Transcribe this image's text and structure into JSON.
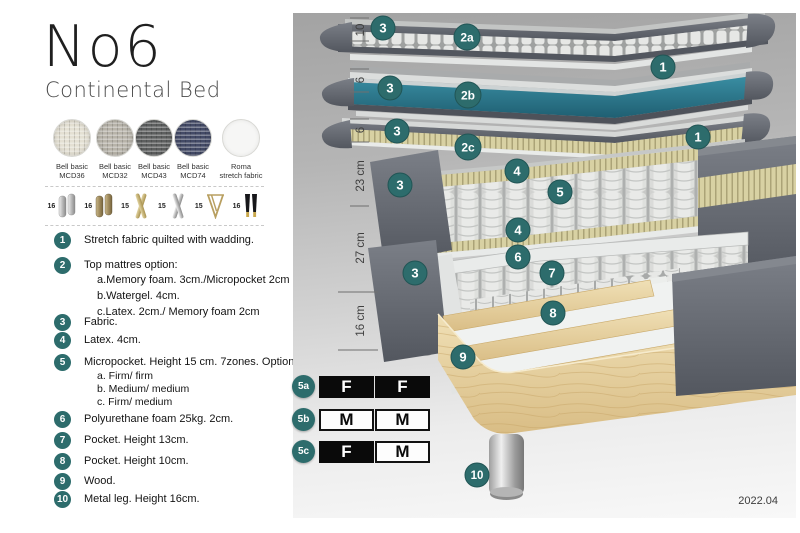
{
  "title": "No6",
  "subtitle": "Continental Bed",
  "version": "2022.04",
  "colors": {
    "accent_teal": "#2d6c6c",
    "watergel_teal": "#2e7f91",
    "cover_gray": "#63676f",
    "wood": "#e6cf9e"
  },
  "fabrics": [
    {
      "name": "Bell basic",
      "code": "MCD36",
      "color": "#e4e0d3"
    },
    {
      "name": "Bell basic",
      "code": "MCD32",
      "color": "#b7b3a9"
    },
    {
      "name": "Bell basic",
      "code": "MCD43",
      "color": "#5d5f5f"
    },
    {
      "name": "Bell basic",
      "code": "MCD74",
      "color": "#434a66"
    },
    {
      "name": "Roma",
      "code": "stretch fabric",
      "color": "#f6f6f5"
    }
  ],
  "legs": [
    {
      "height": "16",
      "style": "cylinder-silver"
    },
    {
      "height": "16",
      "style": "cylinder-brass"
    },
    {
      "height": "15",
      "style": "cross-gold"
    },
    {
      "height": "15",
      "style": "cross-silver"
    },
    {
      "height": "15",
      "style": "hairpin-gold"
    },
    {
      "height": "16",
      "style": "tapered-black-gold"
    }
  ],
  "legend": [
    {
      "num": "1",
      "text": "Stretch fabric quilted with wadding."
    },
    {
      "num": "2",
      "text": "Top mattres option:",
      "sub": [
        "a.Memory foam. 3cm./Micropocket 2cm",
        "b.Watergel. 4cm.",
        "c.Latex. 2cm./ Memory foam 2cm"
      ]
    },
    {
      "num": "3",
      "text": "Fabric."
    },
    {
      "num": "4",
      "text": "Latex. 4cm."
    },
    {
      "num": "5",
      "text": "Micropocket. Height 15 cm. 7zones. Option:",
      "sub": [
        "a. Firm/ firm",
        "b. Medium/ medium",
        "c. Firm/ medium"
      ]
    },
    {
      "num": "6",
      "text": "Polyurethane foam 25kg. 2cm."
    },
    {
      "num": "7",
      "text": "Pocket. Height 13cm."
    },
    {
      "num": "8",
      "text": "Pocket. Height 10cm."
    },
    {
      "num": "9",
      "text": "Wood."
    },
    {
      "num": "10",
      "text": "Metal leg. Height 16cm."
    }
  ],
  "ruler": [
    "10",
    "6",
    "6",
    "23 cm",
    "27 cm",
    "16 cm"
  ],
  "badges": [
    "3",
    "2a",
    "1",
    "3",
    "2b",
    "3",
    "2c",
    "1",
    "4",
    "3",
    "5",
    "4",
    "6",
    "3",
    "7",
    "8",
    "9",
    "10"
  ],
  "firmness": [
    {
      "id": "5a",
      "cells": [
        {
          "text": "F",
          "variant": "dark"
        },
        {
          "text": "F",
          "variant": "dark"
        }
      ]
    },
    {
      "id": "5b",
      "cells": [
        {
          "text": "M",
          "variant": "light"
        },
        {
          "text": "M",
          "variant": "light"
        }
      ]
    },
    {
      "id": "5c",
      "cells": [
        {
          "text": "F",
          "variant": "dark"
        },
        {
          "text": "M",
          "variant": "light"
        }
      ]
    }
  ]
}
